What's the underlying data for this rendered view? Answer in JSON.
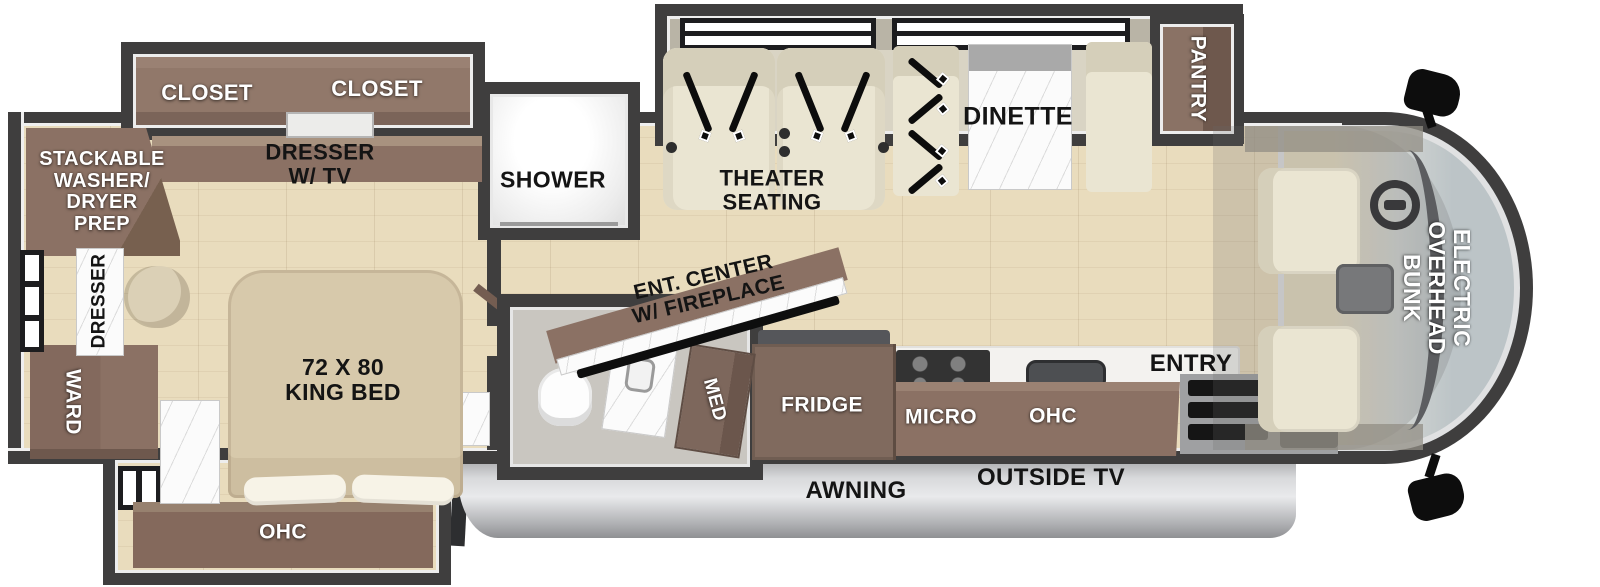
{
  "title": "RV floor plan — Class C motorhome layout",
  "labels": {
    "closet_left": "CLOSET",
    "closet_right": "CLOSET",
    "dresser_tv": "DRESSER\nW/ TV",
    "stackable": "STACKABLE\nWASHER/\nDRYER\nPREP",
    "dresser": "DRESSER",
    "ward": "WARD",
    "king_bed": "72 X 80\nKING BED",
    "ohc_bedroom": "OHC",
    "shower": "SHOWER",
    "med": "MED",
    "ent_center": "ENT. CENTER\nW/ FIREPLACE",
    "theater": "THEATER\nSEATING",
    "dinette": "DINETTE",
    "pantry": "PANTRY",
    "fridge": "FRIDGE",
    "micro": "MICRO",
    "ohc_kitchen": "OHC",
    "entry": "ENTRY",
    "overhead_bunk": "ELECTRIC\nOVERHEAD\nBUNK",
    "awning": "AWNING",
    "outside_tv": "OUTSIDE TV"
  },
  "colors": {
    "wall": "#3f3e3e",
    "cabinet": "#8b7164",
    "cabinet_dark": "#745d51",
    "cabinet_light": "#a8927f",
    "floor": "#e9dcbd",
    "seat": "#eae5d2",
    "seat_shade": "#d5cfba",
    "marble": "#fbfbfb",
    "bath_floor": "#c9c6c0",
    "glass": "#bcc4c7",
    "awning_light": "#e9eaec",
    "awning_dark": "#8f9093",
    "steps_black": "#151515"
  }
}
